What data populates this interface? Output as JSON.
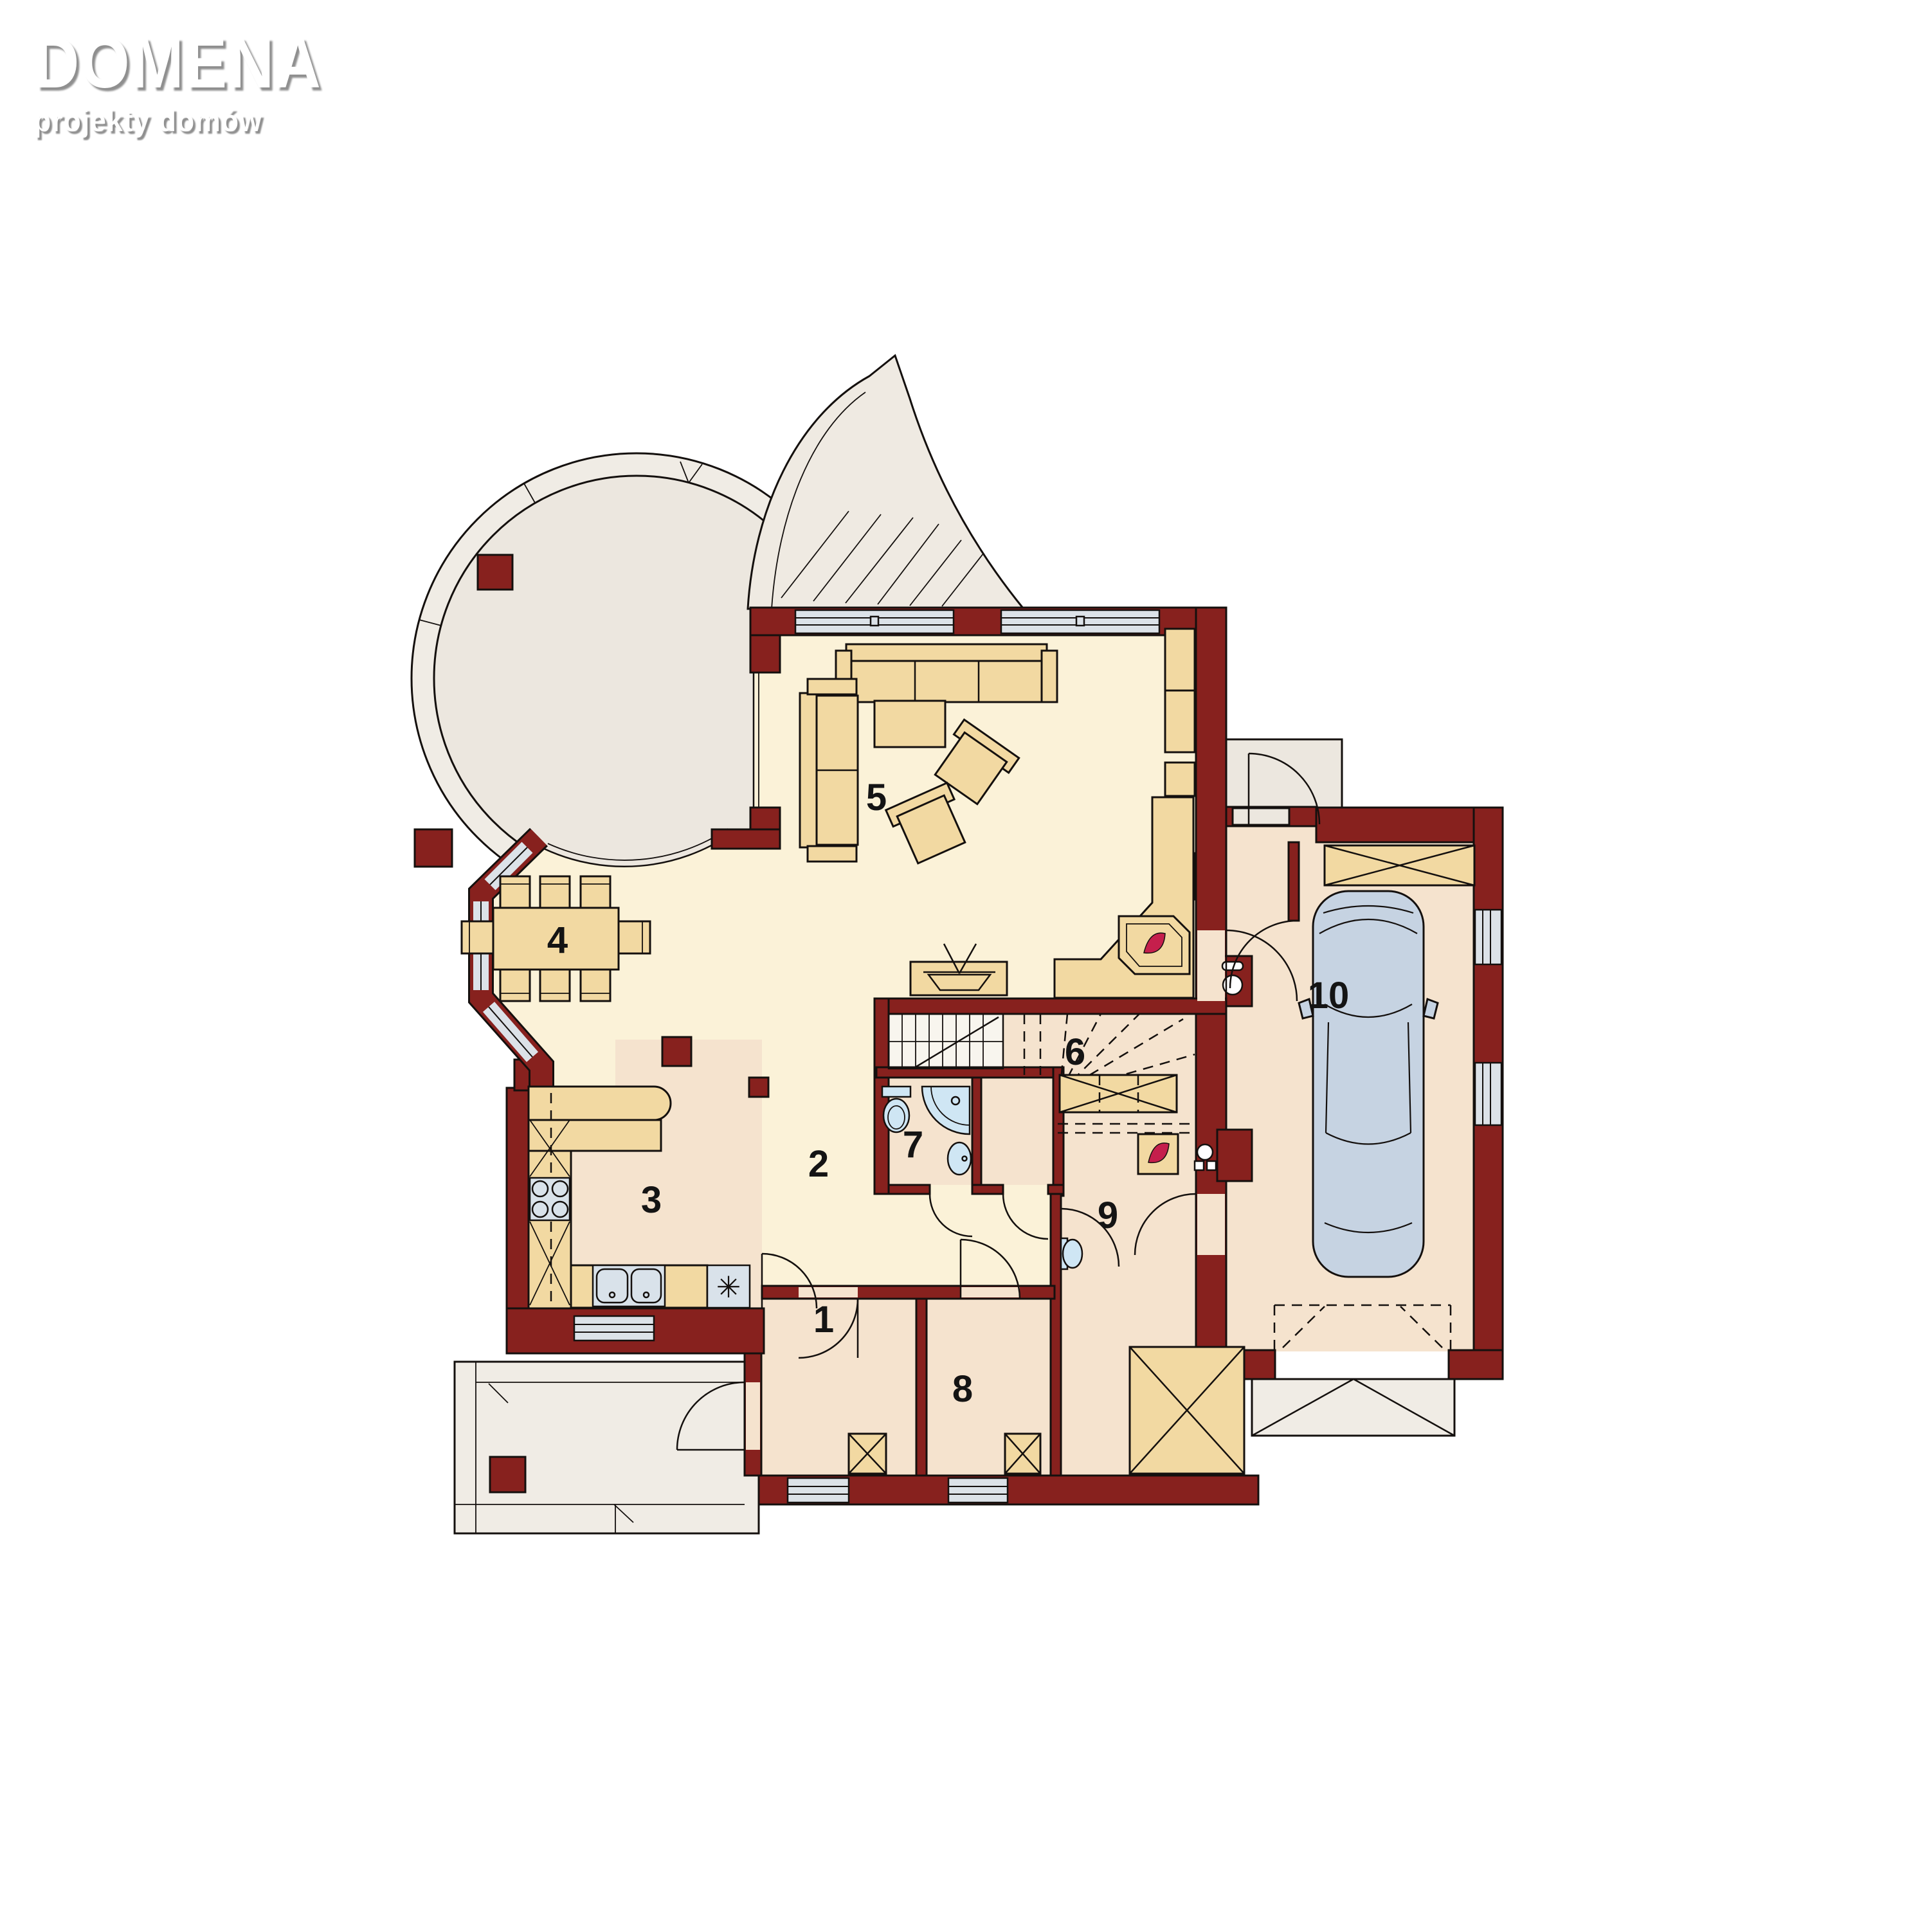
{
  "logo": {
    "title": "DOMENA",
    "subtitle": "projekty domów"
  },
  "rooms": [
    {
      "number": "1"
    },
    {
      "number": "2"
    },
    {
      "number": "3"
    },
    {
      "number": "4"
    },
    {
      "number": "5"
    },
    {
      "number": "6"
    },
    {
      "number": "7"
    },
    {
      "number": "8"
    },
    {
      "number": "9"
    },
    {
      "number": "10"
    }
  ],
  "symbols": {
    "dishwasher": "✳"
  },
  "colors": {
    "wall": "#87211E",
    "floor_cream": "#FBF2D8",
    "floor_pink": "#F5E3CE",
    "terrace": "#ECE7DF",
    "terrace_ring": "#F0ECE5",
    "window": "#DCE2E8",
    "furniture": "#F2D9A2",
    "fixture": "#CFE6F4",
    "appliance": "#D9E2EA",
    "car": "#C6D3E2",
    "flame": "#C51F4C"
  }
}
